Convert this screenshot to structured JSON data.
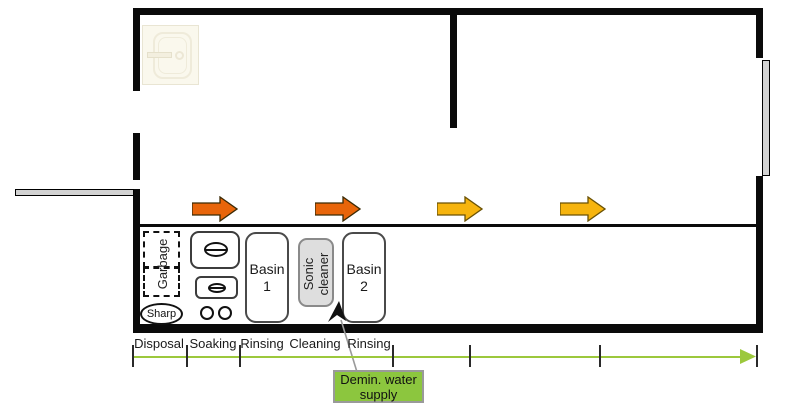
{
  "equipment": {
    "garbage": "Garbage",
    "sharp": "Sharp",
    "basin_1": "Basin 1",
    "sonic_cleaner": "Sonic cleaner",
    "basin_2": "Basin 2"
  },
  "stages": [
    "Disposal",
    "Soaking",
    "Rinsing",
    "Cleaning",
    "Rinsing"
  ],
  "annotations": {
    "demin_water": "Demin. water supply"
  },
  "flow_arrows": [
    {
      "name": "flow-arrow-1",
      "color": "#e8650a"
    },
    {
      "name": "flow-arrow-2",
      "color": "#e8650a"
    },
    {
      "name": "flow-arrow-3",
      "color": "#f6b40e"
    },
    {
      "name": "flow-arrow-4",
      "color": "#f6b40e"
    }
  ],
  "colors": {
    "timeline_green": "#9cc83c",
    "demin_box_green": "#8cc63e",
    "sonic_cleaner_gray": "#dedede",
    "wall_black": "#0a0a0a",
    "door_gray": "#d2d2d2"
  }
}
